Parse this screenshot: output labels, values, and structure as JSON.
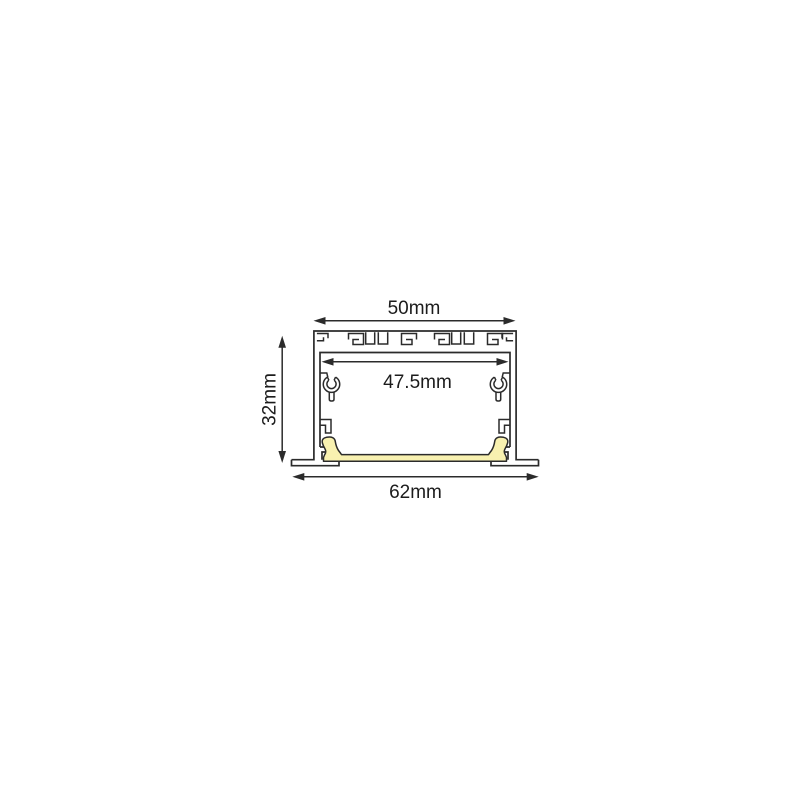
{
  "diagram": {
    "type": "technical-cross-section",
    "dimensions": {
      "top_width": "50mm",
      "inner_width": "47.5mm",
      "height": "32mm",
      "overall_width": "62mm"
    },
    "colors": {
      "line": "#2b2b2b",
      "diffuser_fill": "#f8f1b0",
      "background": "#ffffff"
    }
  }
}
